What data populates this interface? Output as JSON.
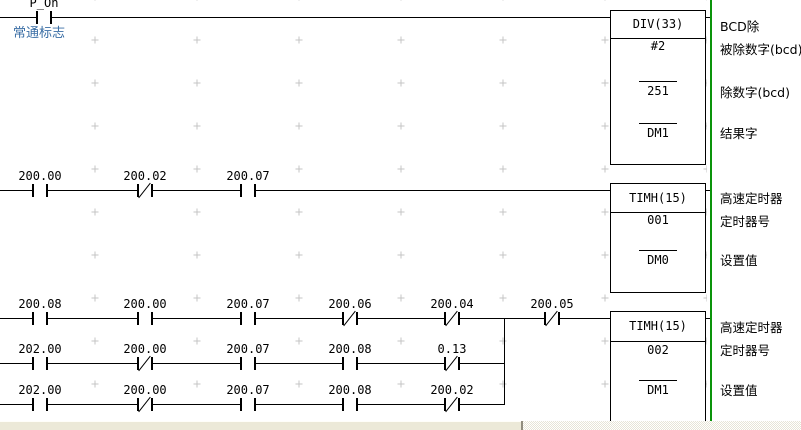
{
  "program": {
    "comment_always_on": "常通标志"
  },
  "contacts": {
    "r1": [
      {
        "label": "P_On",
        "type": "NO"
      }
    ],
    "r2": [
      {
        "label": "200.00",
        "type": "NO"
      },
      {
        "label": "200.02",
        "type": "NC"
      },
      {
        "label": "200.07",
        "type": "NO"
      }
    ],
    "r3a": [
      {
        "label": "200.08",
        "type": "NO"
      },
      {
        "label": "200.00",
        "type": "NO"
      },
      {
        "label": "200.07",
        "type": "NO"
      },
      {
        "label": "200.06",
        "type": "NC"
      },
      {
        "label": "200.04",
        "type": "NC"
      },
      {
        "label": "200.05",
        "type": "NC"
      }
    ],
    "r3b": [
      {
        "label": "202.00",
        "type": "NO"
      },
      {
        "label": "200.00",
        "type": "NC"
      },
      {
        "label": "200.07",
        "type": "NO"
      },
      {
        "label": "200.08",
        "type": "NO"
      },
      {
        "label": "0.13",
        "type": "NC"
      }
    ],
    "r3c": [
      {
        "label": "202.00",
        "type": "NO"
      },
      {
        "label": "200.00",
        "type": "NC"
      },
      {
        "label": "200.07",
        "type": "NO"
      },
      {
        "label": "200.08",
        "type": "NO"
      },
      {
        "label": "200.02",
        "type": "NC"
      }
    ]
  },
  "blocks": [
    {
      "title": "DIV(33)",
      "operands": [
        "#2",
        "251",
        "DM1"
      ],
      "side_labels": [
        "BCD除",
        "被除数字(bcd)",
        "除数字(bcd)",
        "结果字"
      ]
    },
    {
      "title": "TIMH(15)",
      "operands": [
        "001",
        "DM0"
      ],
      "side_labels": [
        "高速定时器",
        "定时器号",
        "设置值"
      ]
    },
    {
      "title": "TIMH(15)",
      "operands": [
        "002",
        "DM1"
      ],
      "side_labels": [
        "高速定时器",
        "定时器号",
        "设置值"
      ]
    }
  ],
  "colors": {
    "bus_bar": "#0a940a",
    "comment_text": "#3a6ea5",
    "grid_mark": "#c4c4c4",
    "wire": "#000000"
  }
}
